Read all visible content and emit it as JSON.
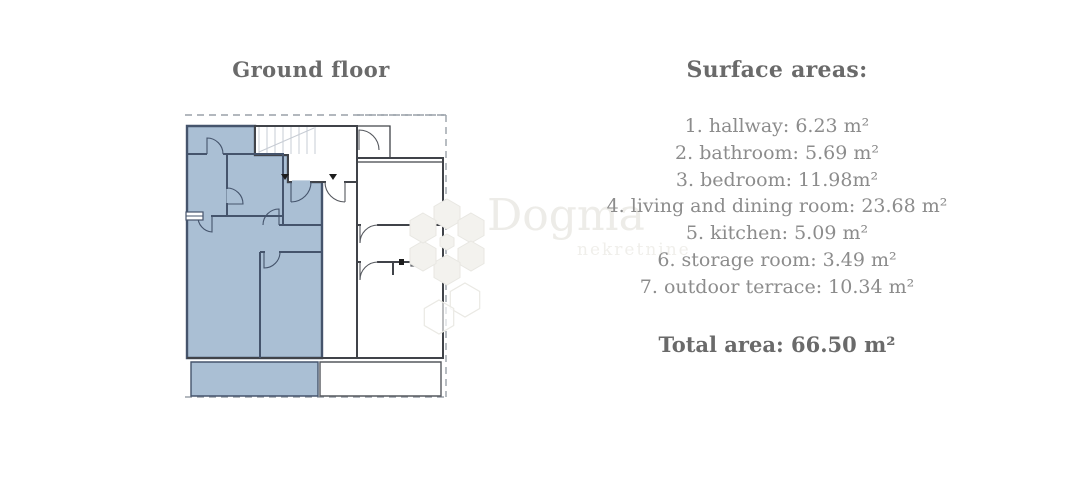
{
  "page": {
    "background": "#ffffff"
  },
  "floor_plan": {
    "title": "Ground floor",
    "highlight_color": "#aabfd4",
    "wall_color": "#45546c"
  },
  "surface_areas": {
    "heading": "Surface areas:",
    "items": [
      "1. hallway: 6.23 m²",
      "2. bathroom: 5.69 m²",
      "3. bedroom: 11.98m²",
      "4. living and dining room: 23.68 m²",
      "5. kitchen: 5.09 m²",
      "6. storage room: 3.49 m²",
      "7. outdoor terrace: 10.34 m²"
    ],
    "total": "Total area: 66.50 m²"
  },
  "watermark": {
    "brand": "Dogma",
    "subtitle": "nekretnine",
    "color": "#edece8"
  }
}
